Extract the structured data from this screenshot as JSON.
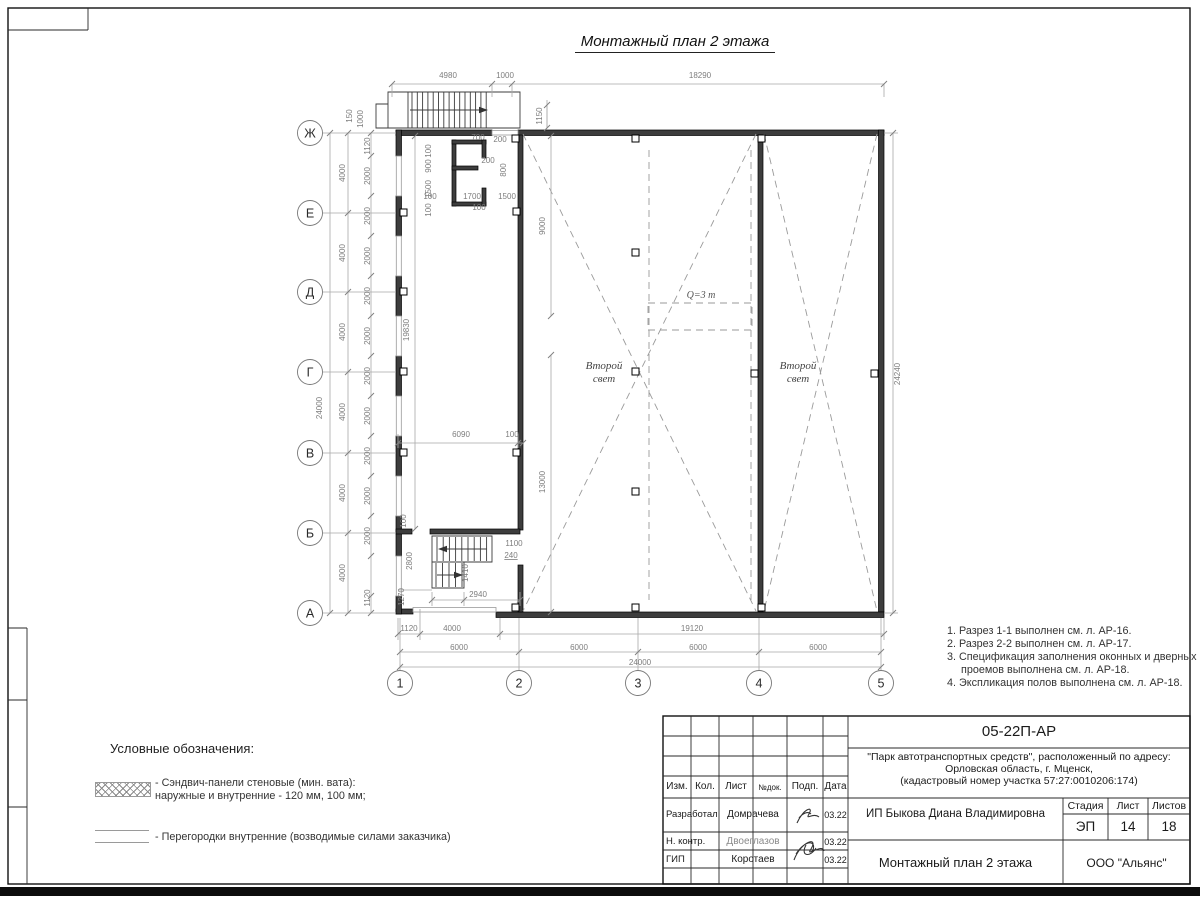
{
  "sheet": {
    "title": "Монтажный план 2 этажа",
    "notes": [
      "1. Разрез 1-1 выполнен см. л. АР-16.",
      "2. Разрез 2-2 выполнен см. л. АР-17.",
      "3. Спецификация заполнения оконных и дверных",
      "проемов выполнена см. л. АР-18.",
      "4. Экспликация полов выполнена см. л. АР-18."
    ],
    "legend": {
      "heading": "Условные обозначения:",
      "item1_line1": "- Сэндвич-панели стеновые (мин. вата):",
      "item1_line2": "наружные и внутренние - 120 мм, 100 мм;",
      "item2": "- Перегородки внутренние (возводимые силами заказчика)"
    }
  },
  "plan": {
    "row_axes": [
      "Ж",
      "Е",
      "Д",
      "Г",
      "В",
      "Б",
      "А"
    ],
    "col_axes": [
      "1",
      "2",
      "3",
      "4",
      "5"
    ],
    "second_light_label": "Второй свет",
    "crane_label": "Q=3 т",
    "dim_labels": [
      {
        "id": "t4980",
        "text": "4980"
      },
      {
        "id": "t1000",
        "text": "1000"
      },
      {
        "id": "t18290",
        "text": "18290"
      },
      {
        "id": "l150",
        "text": "150"
      },
      {
        "id": "l1000",
        "text": "1000"
      },
      {
        "id": "r24240",
        "text": "24240"
      },
      {
        "id": "l24000",
        "text": "24000"
      },
      {
        "id": "l4000_1",
        "text": "4000"
      },
      {
        "id": "l4000_2",
        "text": "4000"
      },
      {
        "id": "l4000_3",
        "text": "4000"
      },
      {
        "id": "l4000_4",
        "text": "4000"
      },
      {
        "id": "l4000_5",
        "text": "4000"
      },
      {
        "id": "l4000_6",
        "text": "4000"
      },
      {
        "id": "lw1120t",
        "text": "1120"
      },
      {
        "id": "lw2000_1",
        "text": "2000"
      },
      {
        "id": "lw2000_2",
        "text": "2000"
      },
      {
        "id": "lw2000_3",
        "text": "2000"
      },
      {
        "id": "lw2000_4",
        "text": "2000"
      },
      {
        "id": "lw2000_5",
        "text": "2000"
      },
      {
        "id": "lw2000_6",
        "text": "2000"
      },
      {
        "id": "lw2000_7",
        "text": "2000"
      },
      {
        "id": "lw2000_8",
        "text": "2000"
      },
      {
        "id": "lw2000_9",
        "text": "2000"
      },
      {
        "id": "lw2000_10",
        "text": "2000"
      },
      {
        "id": "lw1120b",
        "text": "1120"
      },
      {
        "id": "l19830",
        "text": "19830"
      },
      {
        "id": "i1150",
        "text": "1150"
      },
      {
        "id": "i9000",
        "text": "9000"
      },
      {
        "id": "i13000",
        "text": "13000"
      },
      {
        "id": "i6090",
        "text": "6090"
      },
      {
        "id": "i100",
        "text": "100"
      },
      {
        "id": "rm100a",
        "text": "100"
      },
      {
        "id": "rm900",
        "text": "900"
      },
      {
        "id": "rm1500",
        "text": "1500"
      },
      {
        "id": "rm100b",
        "text": "100"
      },
      {
        "id": "rm700",
        "text": "700"
      },
      {
        "id": "rm200a",
        "text": "200"
      },
      {
        "id": "rm200b",
        "text": "200"
      },
      {
        "id": "rm800",
        "text": "800"
      },
      {
        "id": "rm100c",
        "text": "100"
      },
      {
        "id": "rm1700",
        "text": "1700"
      },
      {
        "id": "rm1500b",
        "text": "1500"
      },
      {
        "id": "rm100d",
        "text": "100"
      },
      {
        "id": "st100",
        "text": "100"
      },
      {
        "id": "st2800",
        "text": "2800"
      },
      {
        "id": "st1270",
        "text": "1270"
      },
      {
        "id": "st1100",
        "text": "1100"
      },
      {
        "id": "st240",
        "text": "240"
      },
      {
        "id": "st1410",
        "text": "1410"
      },
      {
        "id": "st2940",
        "text": "2940"
      },
      {
        "id": "b1120",
        "text": "1120"
      },
      {
        "id": "b4000",
        "text": "4000"
      },
      {
        "id": "b19120",
        "text": "19120"
      },
      {
        "id": "b6000_1",
        "text": "6000"
      },
      {
        "id": "b6000_2",
        "text": "6000"
      },
      {
        "id": "b6000_3",
        "text": "6000"
      },
      {
        "id": "b6000_4",
        "text": "6000"
      },
      {
        "id": "b24000",
        "text": "24000"
      }
    ]
  },
  "title_block": {
    "doc_number": "05-22П-АР",
    "project_line1": "\"Парк автотранспортных средств\",  расположенный по адресу:",
    "project_line2": "Орловская область, г. Мценск,",
    "project_line3": "(кадастровый номер участка 57:27:0010206:174)",
    "header_cols": [
      "Изм.",
      "Кол.",
      "Лист",
      "№док.",
      "Подп.",
      "Дата"
    ],
    "stage_header": [
      "Стадия",
      "Лист",
      "Листов"
    ],
    "stage_values": [
      "ЭП",
      "14",
      "18"
    ],
    "client": "ИП Быкова Диана Владимировна",
    "sheet_name": "Монтажный план 2 этажа",
    "company": "ООО \"Альянс\"",
    "rows": [
      {
        "role": "Разработал",
        "name": "Домрачева",
        "date": "03.22"
      },
      {
        "role": "Н. контр.",
        "name": "Двоеглазов",
        "date": "03.22"
      },
      {
        "role": "ГИП",
        "name": "Коротаев",
        "date": "03.22"
      }
    ]
  }
}
